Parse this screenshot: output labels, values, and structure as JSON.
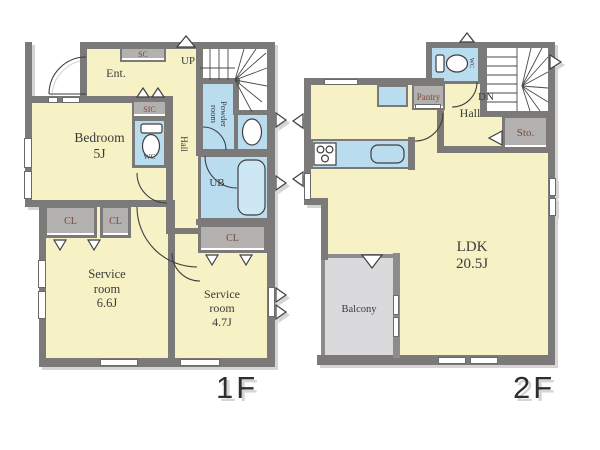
{
  "colors": {
    "room_fill": "#f6f2c5",
    "wet_area_fill": "#b9dcef",
    "closet_fill": "#b3b0b0",
    "wall": "#7c7979",
    "balcony_fill": "#dadadd",
    "closet_text": "#7b4a38",
    "label_text": "#3b3b3b"
  },
  "floor1": {
    "label": "1F",
    "rooms": {
      "entrance": {
        "name": "Ent."
      },
      "shoe_closet": {
        "name": "SC"
      },
      "shoe_in_closet": {
        "name": "SIC"
      },
      "stairs_up": {
        "name": "UP"
      },
      "hall": {
        "name": "Hall"
      },
      "wc": {
        "name": "WC"
      },
      "powder_room": {
        "name": "Powder room"
      },
      "unit_bath": {
        "name": "UB"
      },
      "bedroom": {
        "name": "Bedroom",
        "size": "5J"
      },
      "closet": {
        "name": "CL"
      },
      "service_room_1": {
        "name": "Service room",
        "size": "6.6J"
      },
      "service_room_2": {
        "name": "Service room",
        "size": "4.7J"
      }
    }
  },
  "floor2": {
    "label": "2F",
    "rooms": {
      "ldk": {
        "name": "LDK",
        "size": "20.5J"
      },
      "hall": {
        "name": "Hall"
      },
      "stairs_down": {
        "name": "DN"
      },
      "wc": {
        "name": "WC"
      },
      "pantry": {
        "name": "Pantry"
      },
      "storage": {
        "name": "Sto."
      },
      "balcony": {
        "name": "Balcony"
      }
    }
  }
}
